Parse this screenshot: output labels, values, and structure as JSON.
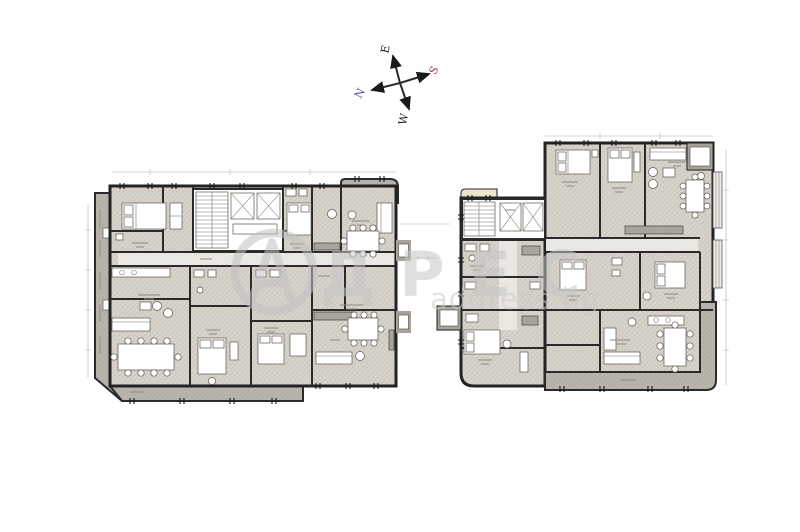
{
  "compass": {
    "east_label": "E",
    "south_label": "S",
    "north_label": "N",
    "west_label": "W",
    "axis_color": "#1b1b1b",
    "north_color": "#4d4da6",
    "south_color": "#b23a34"
  },
  "watermark": {
    "logo_letter": "А",
    "brand_letters": "ДРЕС",
    "domain_text": "address.bg",
    "color": "#c9c9c9"
  },
  "palette": {
    "floor": "#d7d3cb",
    "floor_light": "#e9e7e1",
    "terrace": "#b9b5ad",
    "terrace_dark": "#a7a39b",
    "balcony_highlight": "#eae6cc",
    "wall": "#2a2a2a",
    "background": "#ffffff"
  }
}
